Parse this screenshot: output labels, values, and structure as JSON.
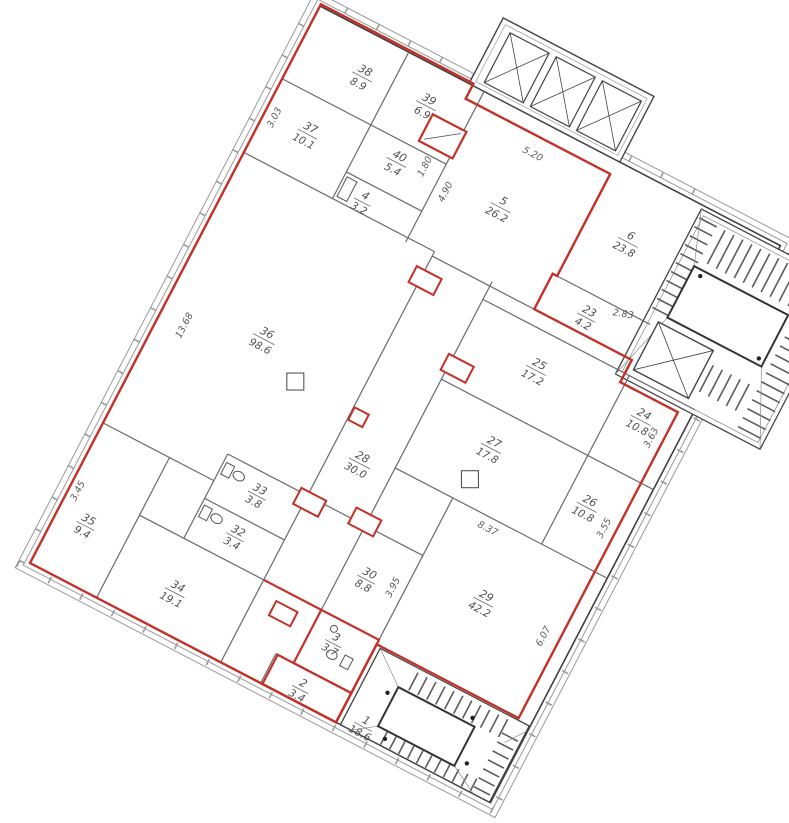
{
  "drawing": {
    "type": "architectural floor plan",
    "colors": {
      "outline_red": "#c43028",
      "wall_dark": "#3f3f3f",
      "wall_gray": "#6a6a6a",
      "band_gray": "#9a9a9a",
      "text_gray": "#4f4f4f"
    }
  },
  "rooms": {
    "r1": {
      "number": "1",
      "area": "18.6"
    },
    "r2": {
      "number": "2",
      "area": "3.4"
    },
    "r3": {
      "number": "3",
      "area": "3.7"
    },
    "r4": {
      "number": "4",
      "area": "3.2"
    },
    "r5": {
      "number": "5",
      "area": "26.2"
    },
    "r6": {
      "number": "6",
      "area": "23.8"
    },
    "r23": {
      "number": "23",
      "area": "4.2"
    },
    "r24": {
      "number": "24",
      "area": "10.8"
    },
    "r25": {
      "number": "25",
      "area": "17.2"
    },
    "r26": {
      "number": "26",
      "area": "10.8"
    },
    "r27": {
      "number": "27",
      "area": "17.8"
    },
    "r28": {
      "number": "28",
      "area": "30.0"
    },
    "r29": {
      "number": "29",
      "area": "42.2"
    },
    "r30": {
      "number": "30",
      "area": "8.8"
    },
    "r32": {
      "number": "32",
      "area": "3.4"
    },
    "r33": {
      "number": "33",
      "area": "3.8"
    },
    "r34": {
      "number": "34",
      "area": "19.1"
    },
    "r35": {
      "number": "35",
      "area": "9.4"
    },
    "r36": {
      "number": "36",
      "area": "98.6"
    },
    "r37": {
      "number": "37",
      "area": "10.1"
    },
    "r38": {
      "number": "38",
      "area": "8.9"
    },
    "r39": {
      "number": "39",
      "area": "6.9"
    },
    "r40": {
      "number": "40",
      "area": "5.4"
    }
  },
  "dims": {
    "left_37": "3.03",
    "left_36": "13.68",
    "left_35": "3.45",
    "top_5": "5.20",
    "room5_left": "4.90",
    "room40_right": "1.80",
    "corr23": "2.83",
    "right_24": "3.63",
    "right_26": "3.55",
    "wall_27_29": "8.37",
    "room30_right": "3.95",
    "right_29": "6.07"
  }
}
